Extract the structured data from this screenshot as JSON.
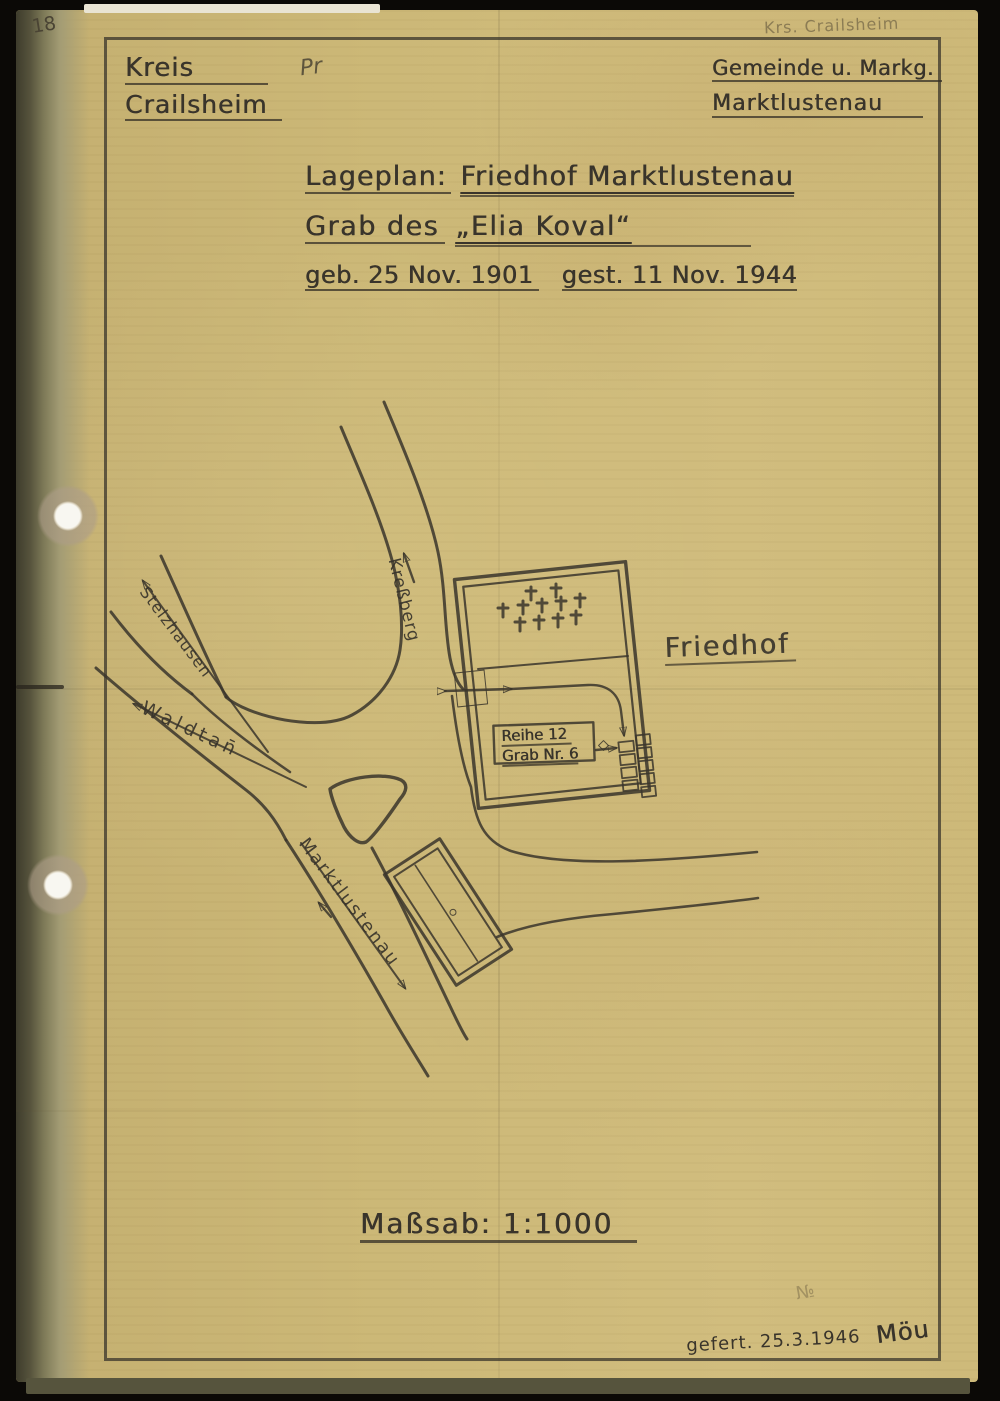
{
  "document": {
    "page_number": "18",
    "corner_note": "Krs. Crailsheim",
    "header": {
      "left_line1": "Kreis",
      "left_line2": "Crailsheim",
      "left_mark": "Pr",
      "right_line1": "Gemeinde u. Markg.",
      "right_line2": "Marktlustenau"
    },
    "title": {
      "line1_label": "Lageplan:",
      "line1_value": "Friedhof Marktlustenau",
      "line2_prefix": "Grab des",
      "line2_name": "„Elia Koval“",
      "line3_birth": "geb. 25 Nov. 1901",
      "line3_death": "gest. 11 Nov. 1944"
    },
    "scale_label": "Maßsab: 1:1000",
    "footer": {
      "made_note": "gefert. 25.3.1946",
      "signature": "Möu",
      "faint_mark": "№"
    }
  },
  "map": {
    "labels": {
      "cemetery": "Friedhof",
      "road_north": "Kreßberg",
      "road_northwest": "Stelzhausen",
      "road_southwest": "Waldtan̄",
      "road_south": "Marktlustenau",
      "grave_row": "Reihe 12",
      "grave_number": "Grab Nr. 6"
    }
  },
  "colors": {
    "paper": "#ccb877",
    "pencil": "#3a352b",
    "background": "#0b0906",
    "hole_white": "#f8f7f1"
  }
}
